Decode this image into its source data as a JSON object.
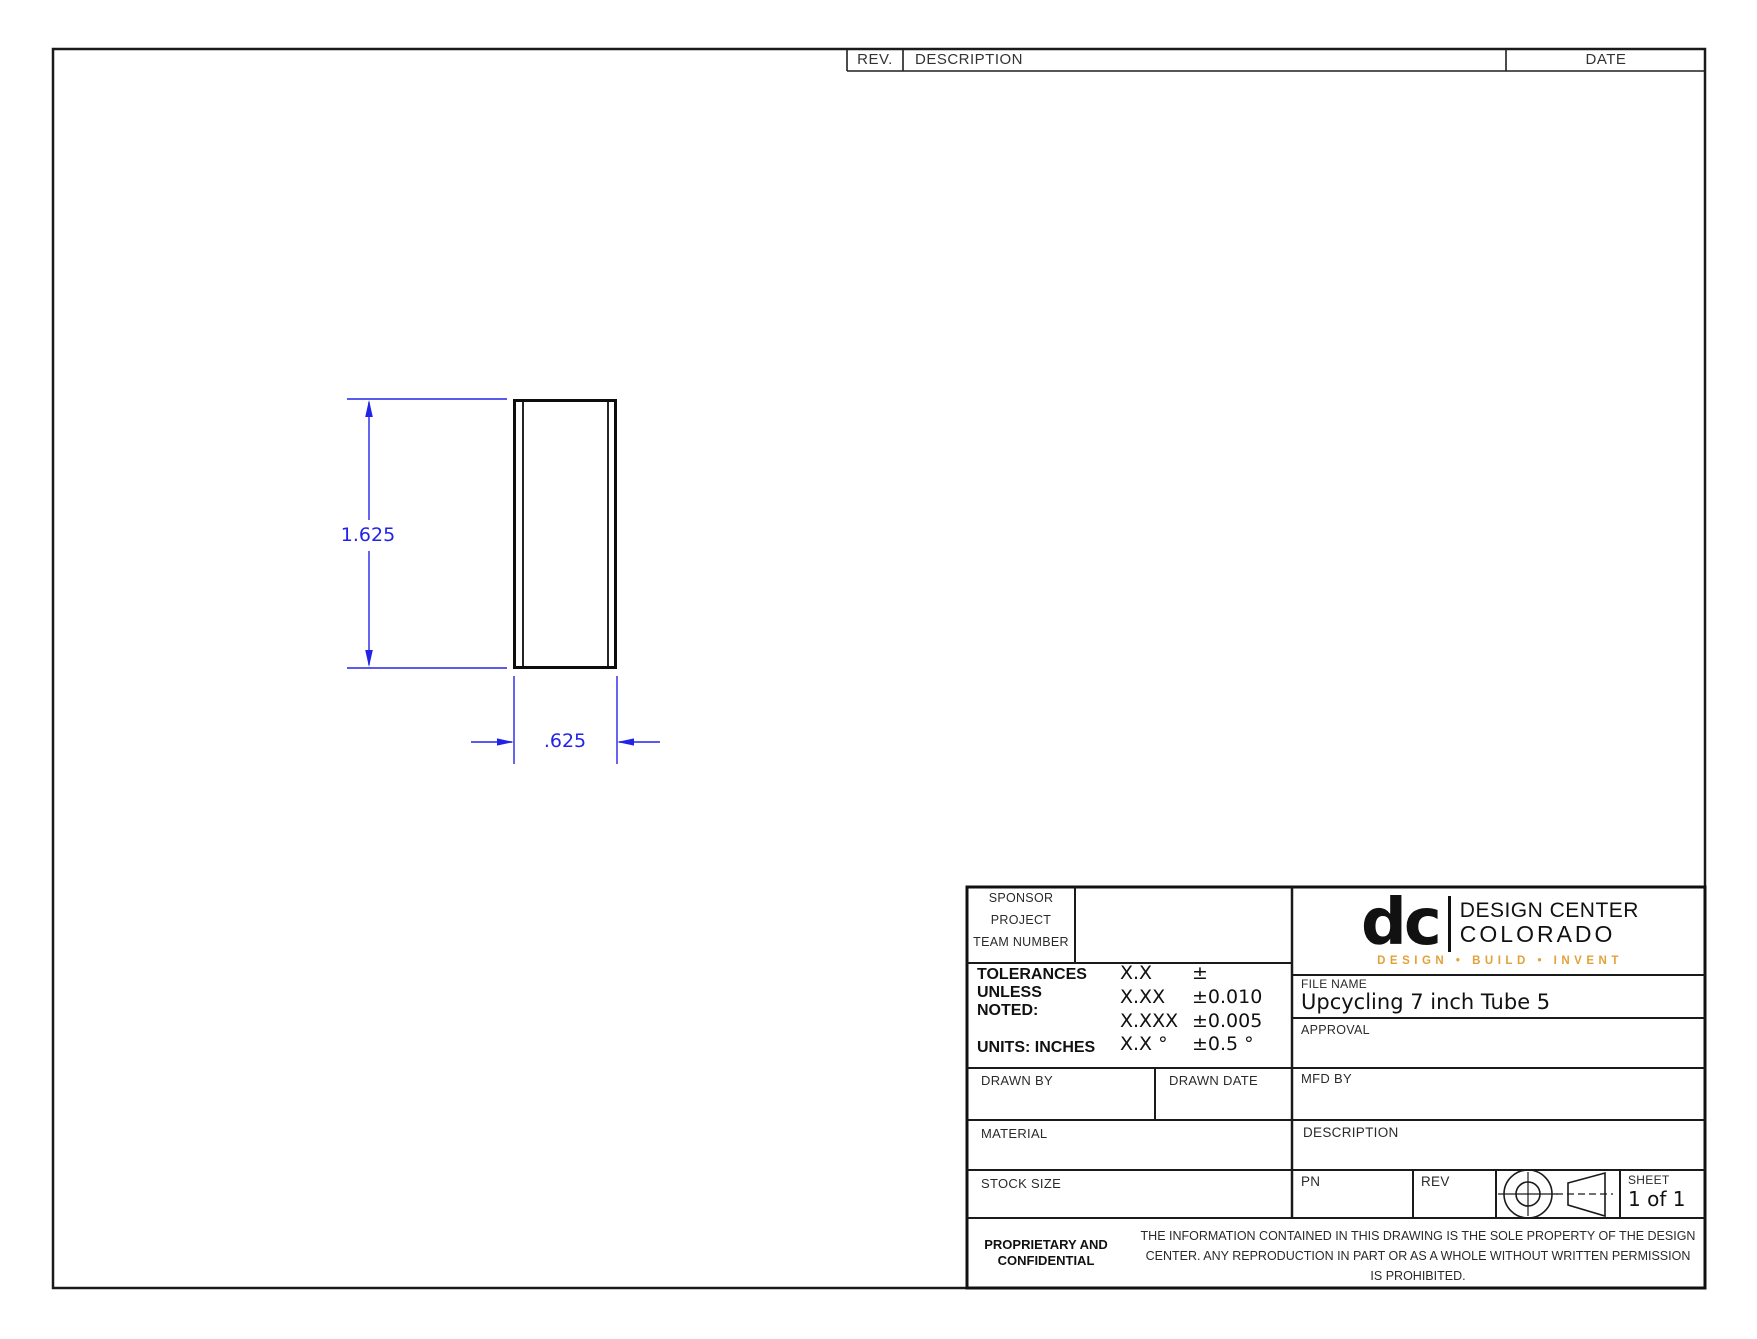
{
  "sheet": {
    "background": "#ffffff",
    "line_color": "#1a1a1a",
    "dimension_color": "#2323e8"
  },
  "revision_table": {
    "rev_label": "REV.",
    "description_label": "DESCRIPTION",
    "date_label": "DATE"
  },
  "drawing": {
    "view": "side view of rectangular tube",
    "height_dimension": "1.625",
    "width_dimension": ".625"
  },
  "logo": {
    "monogram": "dc",
    "name_line1": "DESIGN CENTER",
    "name_line2": "COLORADO",
    "tagline": "DESIGN • BUILD • INVENT",
    "tagline_color": "#E2A139"
  },
  "title_block": {
    "sponsor_label": "SPONSOR",
    "project_label": "PROJECT",
    "team_number_label": "TEAM NUMBER",
    "tolerances": {
      "heading_line1": "TOLERANCES",
      "heading_line2": "UNLESS",
      "heading_line3": "NOTED:",
      "units_label": "UNITS: INCHES",
      "rows": [
        {
          "spec": "X.X",
          "tol": "±"
        },
        {
          "spec": "X.XX",
          "tol": "±0.010"
        },
        {
          "spec": "X.XXX",
          "tol": "±0.005"
        },
        {
          "spec": "X.X °",
          "tol": "±0.5 °"
        }
      ]
    },
    "drawn_by_label": "DRAWN BY",
    "drawn_date_label": "DRAWN DATE",
    "material_label": "MATERIAL",
    "stock_size_label": "STOCK SIZE",
    "file_name_label": "FILE NAME",
    "file_name_value": "Upcycling 7 inch Tube 5",
    "approval_label": "APPROVAL",
    "mfd_by_label": "MFD BY",
    "description_label": "DESCRIPTION",
    "pn_label": "PN",
    "rev_label": "REV",
    "sheet_label": "SHEET",
    "sheet_value": "1 of 1",
    "proprietary_line1": "PROPRIETARY AND",
    "proprietary_line2": "CONFIDENTIAL",
    "legal_text": "THE INFORMATION CONTAINED IN THIS DRAWING IS THE SOLE PROPERTY OF THE DESIGN CENTER. ANY REPRODUCTION IN PART OR AS A WHOLE WITHOUT WRITTEN PERMISSION IS PROHIBITED."
  }
}
